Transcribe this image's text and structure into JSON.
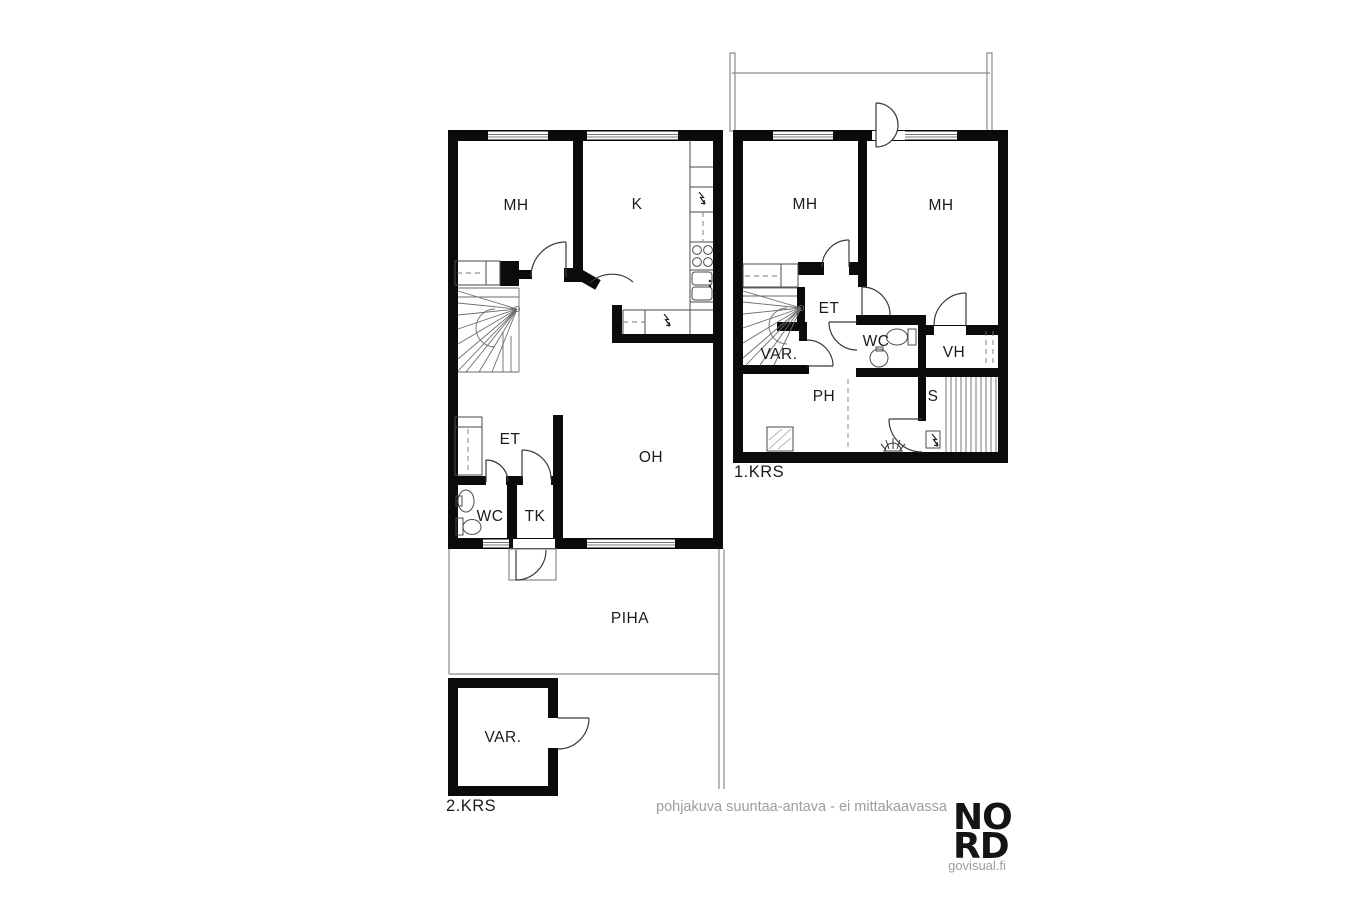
{
  "upper_floor": {
    "floor_label": "2.KRS",
    "rooms": {
      "bedroom": "MH",
      "kitchen": "K",
      "hall": "ET",
      "toilet": "WC",
      "vestibule": "TK",
      "living_room": "OH"
    },
    "yard_label": "PIHA",
    "storage_label": "VAR."
  },
  "ground_floor": {
    "floor_label": "1.KRS",
    "rooms": {
      "bedroom_left": "MH",
      "bedroom_right": "MH",
      "hall": "ET",
      "storage": "VAR.",
      "toilet": "WC",
      "closet": "VH",
      "washroom": "PH",
      "sauna": "S"
    }
  },
  "footer": {
    "disclaimer": "pohjakuva suuntaa-antava - ei mittakaavassa",
    "brand_line1": "NO",
    "brand_line2": "RD",
    "brand_url": "govisual.fi"
  },
  "colors": {
    "wall": "#0b0b0b",
    "thin_line": "#8a8a8a",
    "door_stroke": "#3a3a3a",
    "label_text": "#1b1b1b",
    "muted_text": "#9d9d9d",
    "background": "#ffffff"
  }
}
